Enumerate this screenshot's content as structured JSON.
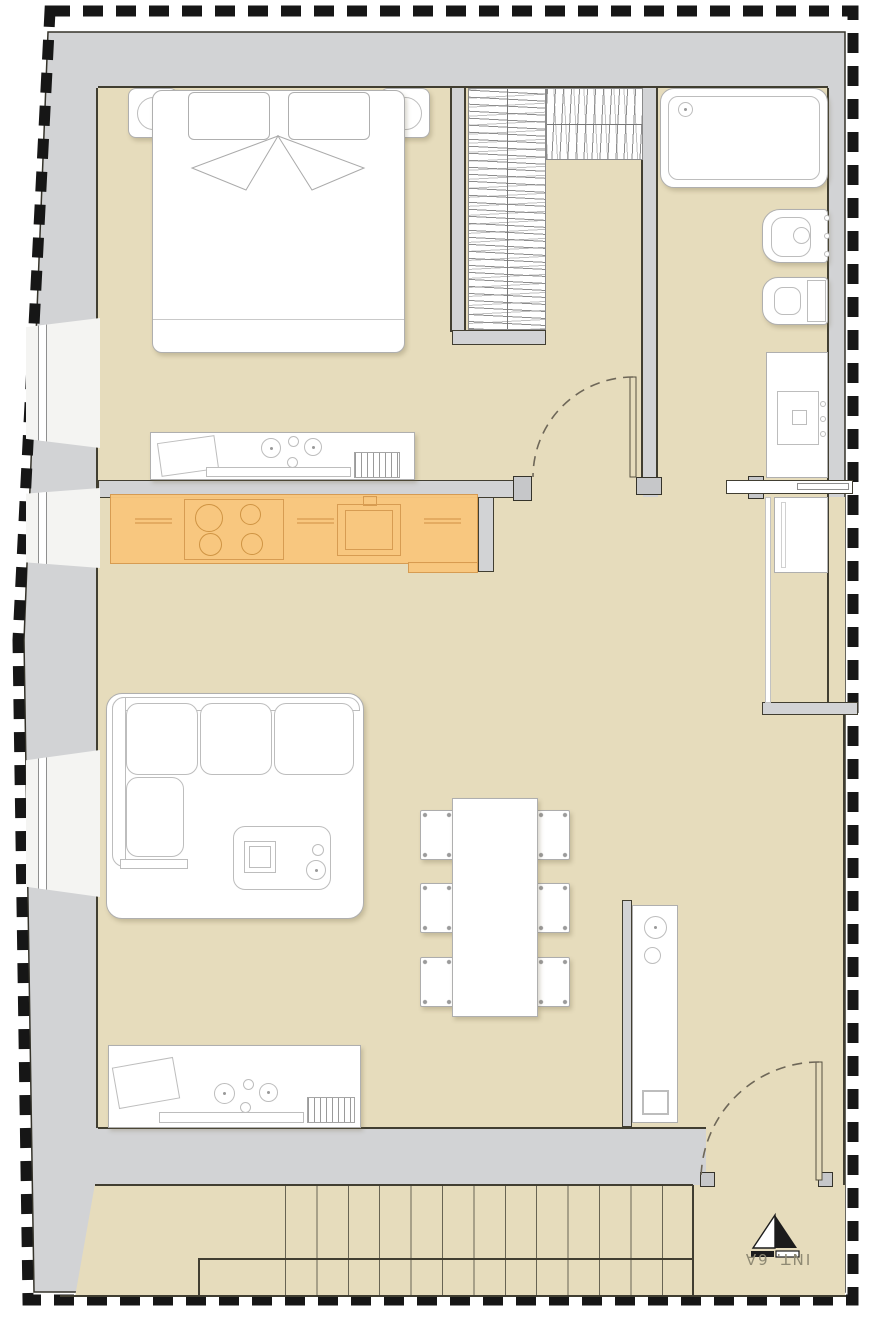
{
  "meta": {
    "type": "architectural-floor-plan",
    "view": "top-down apartment plan"
  },
  "label": {
    "unit": "INT. 6A"
  },
  "colors": {
    "background": "#FFFFFF",
    "floor": "#E6DCBC",
    "wall": "#D2D3D5",
    "outline": "#413E31",
    "boundary": "#161616",
    "highlight": "#F9C77E",
    "highlight_line": "#D79A4F",
    "fixture_line": "#AFAFAF"
  },
  "stairs": {
    "tread_count": 13
  },
  "fixtures": [
    "double-bed",
    "pillows",
    "nightstand-left",
    "nightstand-right",
    "bedside-lamps",
    "wardrobe-rack-vertical",
    "wardrobe-rack-top",
    "bathtub",
    "bidet",
    "toilet",
    "sink-vanity",
    "sliding-door",
    "washing-machine",
    "kitchen-counter-highlighted",
    "stove-4-burner",
    "kitchen-sink",
    "dresser-counter-bedroom",
    "dresser-counter-living",
    "rug",
    "sofa-l-shaped",
    "coffee-table",
    "dining-table",
    "dining-chairs-6",
    "tall-cabinet",
    "window-1",
    "window-2",
    "window-3",
    "bedroom-door-arc",
    "entry-door-arc",
    "staircase",
    "entrance-marker"
  ]
}
